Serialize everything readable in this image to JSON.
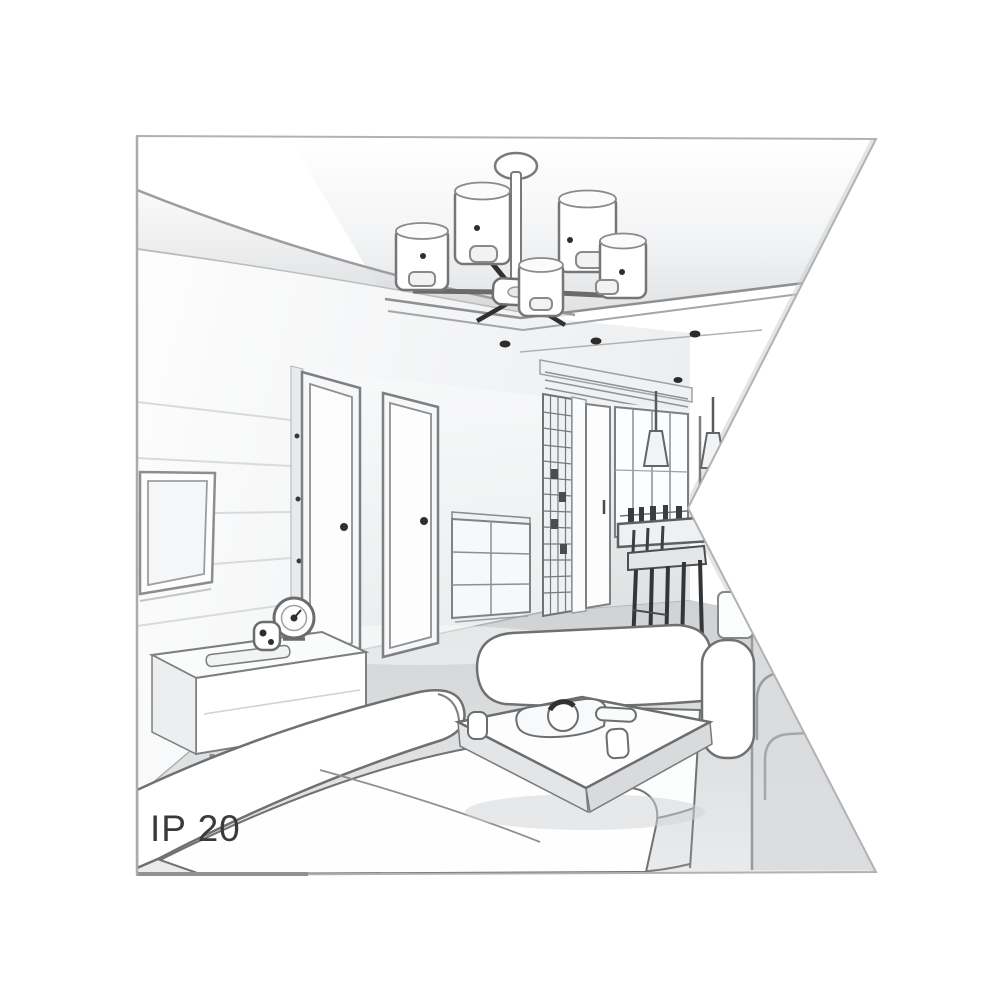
{
  "illustration": {
    "label": "IP 20",
    "style": "grayscale line-art perspective sketch of an apartment interior, clipped by a triangular notch on the right edge",
    "palette": {
      "background": "#ffffff",
      "frame_border": "#b0b2b4",
      "outline": "#6e7072",
      "outline_dark": "#2e2e2e",
      "fill_white": "#ffffff",
      "fill_light": "#f2f3f4",
      "fill_mid": "#e2e3e5",
      "floor": "#d8dadc",
      "label_text": "#3a3a3a"
    },
    "scene_objects": [
      "ceiling-chandelier-with-cylinder-shades",
      "tray-ceiling",
      "recessed-spotlights",
      "cove-ceiling-curves",
      "tv-panel-wall",
      "wall-mounted-tv",
      "interior-door-left",
      "interior-door-right",
      "tv-stand-sideboard",
      "table-clock",
      "mini-speaker",
      "remote-control",
      "chest-of-drawers",
      "glass-partition",
      "hallway-door",
      "dining-window",
      "pendant-cone-lamps",
      "dining-table-with-bottles",
      "dining-chairs",
      "left-sofa",
      "right-sofa",
      "side-armchair",
      "coffee-table",
      "tea-tray-and-teapot",
      "cups"
    ]
  }
}
